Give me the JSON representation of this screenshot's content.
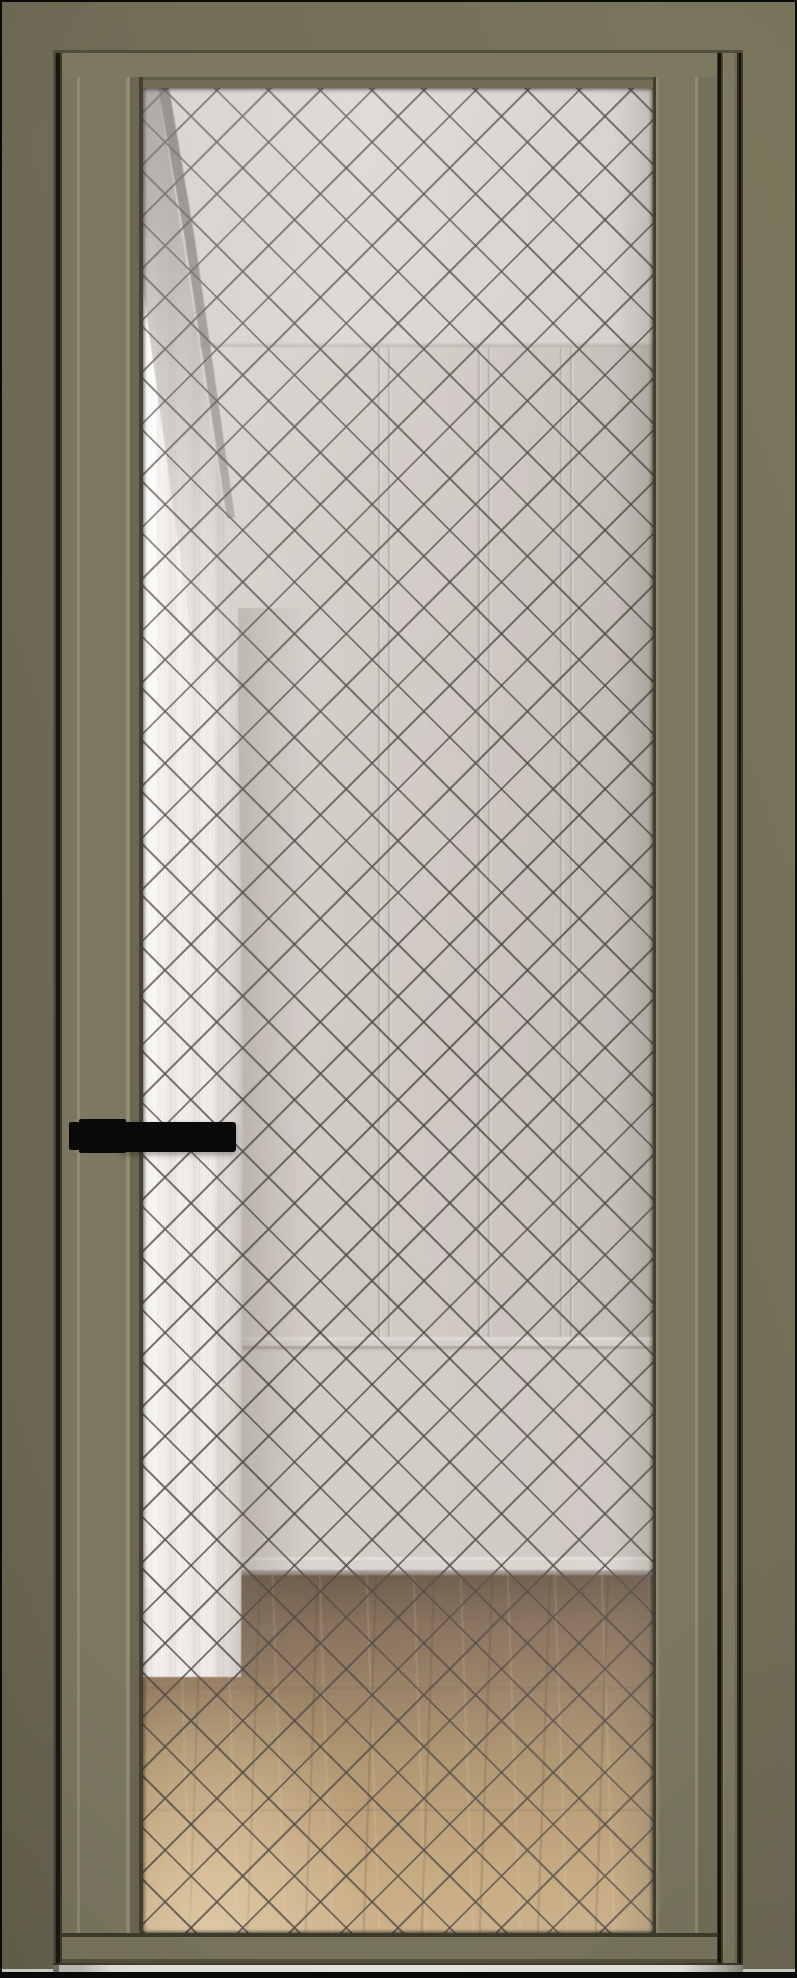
{
  "image": {
    "width_px": 797,
    "height_px": 1978,
    "kind": "product-render",
    "subject": "closed interior door with full-height glass panel, front view"
  },
  "door": {
    "frame_finish": "smoky olive matte profile",
    "leaf_style": "narrow aluminum stiles with fluted ridges, full glass insert",
    "glass": {
      "type": "frosted clear glass",
      "pattern": "diamond lattice grid",
      "lattice_pitch_px": 52,
      "lattice_line_style": "thin dark stitched line"
    },
    "handle": {
      "type": "lever handle",
      "finish": "matte black",
      "side": "left",
      "orientation": "horizontal, pointing right over the glass"
    }
  },
  "room_through_glass": {
    "elements": [
      "light gray ceiling",
      "paneled wall with vertical battens",
      "chair rail molding",
      "plain lower wall",
      "light baseboard",
      "oak wood plank floor",
      "sheer white curtain hanging on the left",
      "sunlight patch on floor at lower left"
    ],
    "curtain_side": "left",
    "floor_material": "light oak planks receding in perspective"
  },
  "colors": {
    "border_black": "#0A0A08",
    "wall": "#6F6B56",
    "wall_light": "#7C775D",
    "wall_dark": "#67634F",
    "frame_face": "#7D7961",
    "frame_step": "#5F5C49",
    "frame_inner": "#6F6B55",
    "frame_edge_dark": "#514E3D",
    "leaf_face": "#7A7660",
    "ridge": "#908C72",
    "leaf_slope": "#6B6753",
    "leaf_edge_dark": "#45422F",
    "gap_dark": "#191810",
    "rail_face": "#7B7760",
    "rail_dark": "#55523F",
    "threshold_white": "#ECEBE5",
    "ceiling": "#D6D2CC",
    "ceiling_dim": "#D2CEC8",
    "room_wall": "#CCC6C0",
    "room_wall_dark": "#BBB5AF",
    "room_wall_light": "#D2CCC6",
    "seam": "#ACA6A0",
    "chair_rail": "#D3CEC8",
    "baseboard": "#D7D2CC",
    "floor_dark": "#5E4B38",
    "floor_mid": "#A78A60",
    "floor_light": "#CFAF80",
    "curtain_light": "#F5F3EF",
    "curtain_mid": "#DFD9D1",
    "curtain_dark": "#C3BCB4",
    "curtain_shade": "#88837C",
    "lattice_line": "#3E3832C4",
    "handle_black": "#0A0A0A"
  },
  "metrics": {
    "lattice_period_px": 36.6,
    "lattice_line_px": 2
  }
}
